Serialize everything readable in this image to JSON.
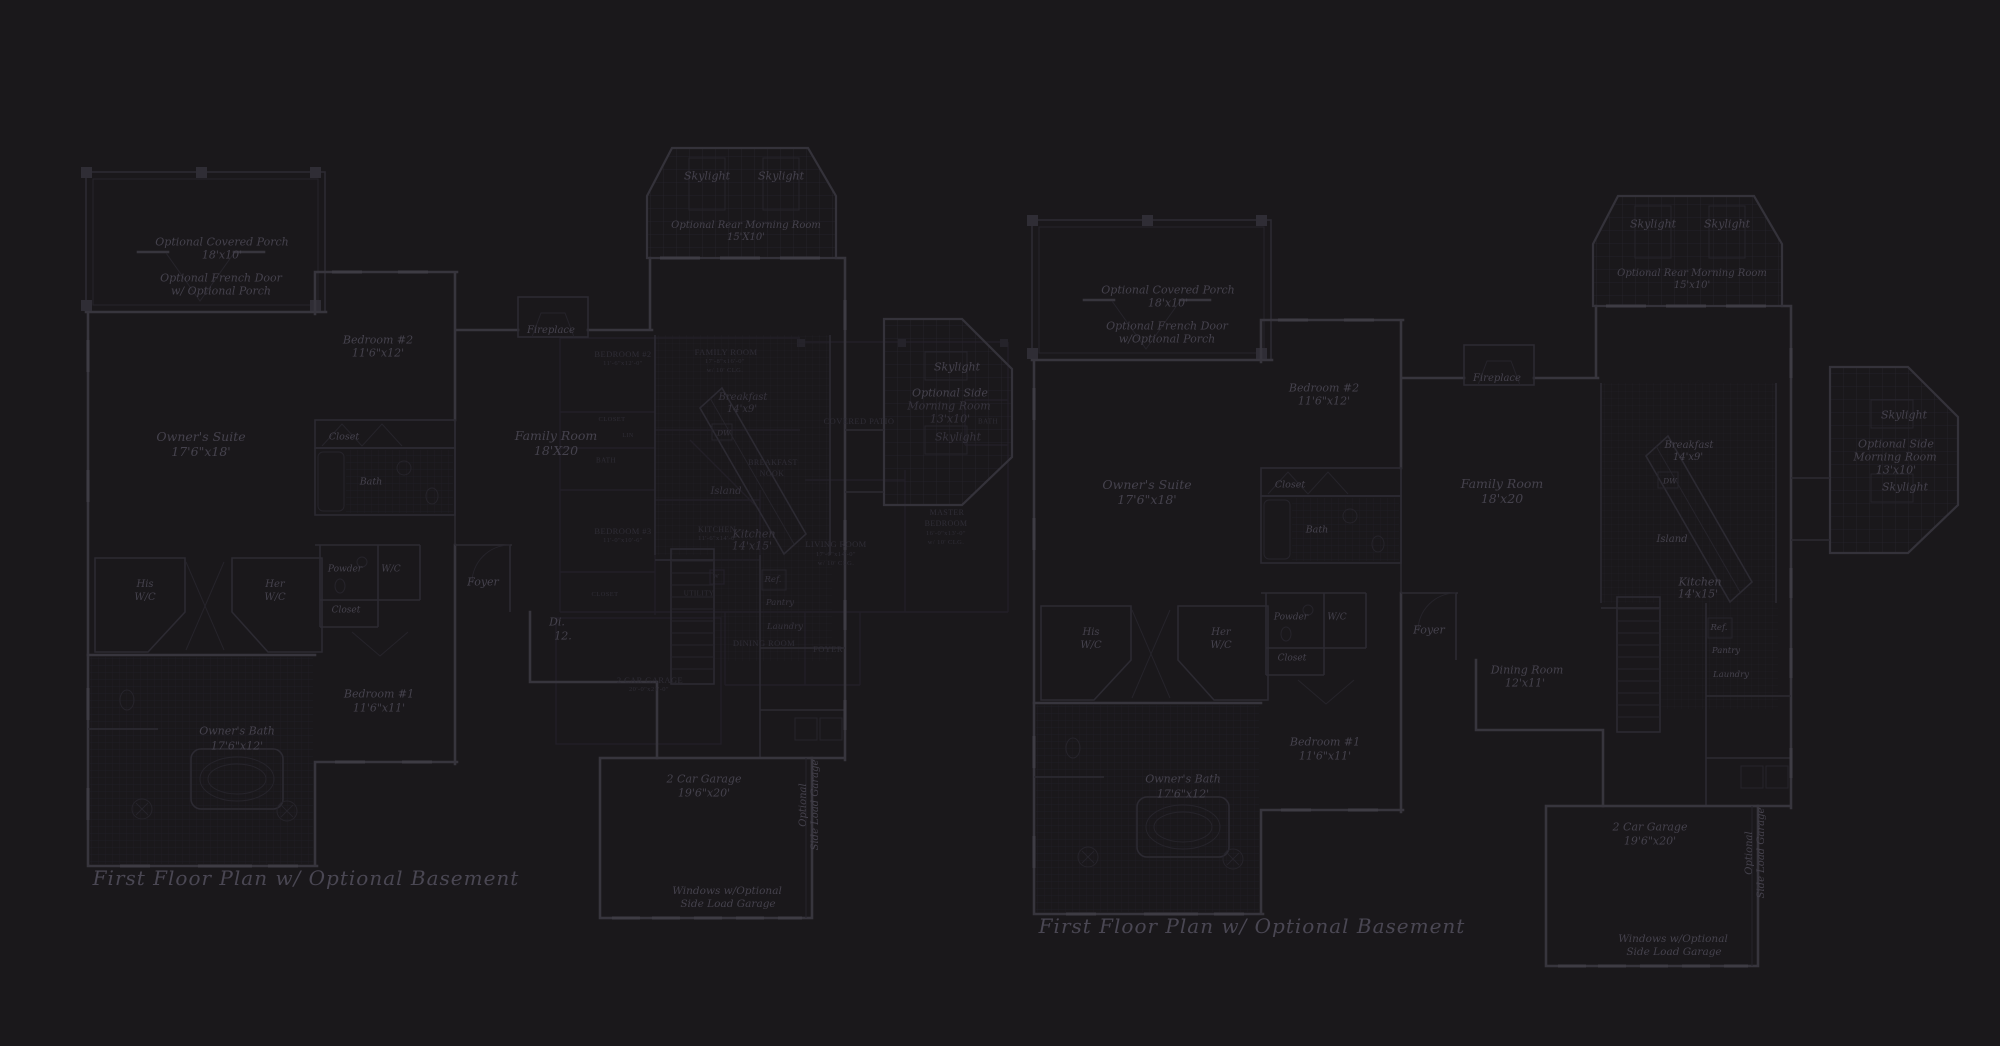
{
  "meta": {
    "figure_type": "architectural floor plan blueprint (dark background composite)",
    "colors": {
      "background": "#1a181b",
      "main_wall": "#37353d",
      "detail_line": "#2c2a32",
      "window_tick": "#3e3c44",
      "label_text": "#45424d",
      "faint_label_text": "#37343e",
      "overlay_text": "#2f2d36",
      "title_text": "#4a4753"
    }
  },
  "plans": {
    "left_plan": {
      "title": "First Floor Plan  w/ Optional Basement",
      "title_x": 306,
      "title_y": 878,
      "title_size": 20,
      "labels": [
        {
          "t": "Optional Covered Porch",
          "x": 222,
          "y": 242,
          "s": 11
        },
        {
          "t": "18'x10'",
          "x": 222,
          "y": 255,
          "s": 11
        },
        {
          "t": "Optional French Door",
          "x": 221,
          "y": 278,
          "s": 11
        },
        {
          "t": "w/ Optional Porch",
          "x": 221,
          "y": 291,
          "s": 11
        },
        {
          "t": "Skylight",
          "x": 707,
          "y": 176,
          "s": 11
        },
        {
          "t": "Skylight",
          "x": 781,
          "y": 176,
          "s": 11
        },
        {
          "t": "Optional Rear Morning Room",
          "x": 746,
          "y": 226,
          "s": 10
        },
        {
          "t": "15'X10'",
          "x": 746,
          "y": 238,
          "s": 10
        },
        {
          "t": "Bedroom #2",
          "x": 378,
          "y": 340,
          "s": 11
        },
        {
          "t": "11'6\"x12'",
          "x": 378,
          "y": 353,
          "s": 11
        },
        {
          "t": "Owner's Suite",
          "x": 201,
          "y": 437,
          "s": 12.5
        },
        {
          "t": "17'6\"x18'",
          "x": 201,
          "y": 452,
          "s": 12.5
        },
        {
          "t": "Closet",
          "x": 344,
          "y": 437,
          "s": 9.5
        },
        {
          "t": "Bath",
          "x": 371,
          "y": 482,
          "s": 9.5
        },
        {
          "t": "Fireplace",
          "x": 551,
          "y": 331,
          "s": 10
        },
        {
          "t": "Family Room",
          "x": 556,
          "y": 436,
          "s": 12.5
        },
        {
          "t": "18'X20",
          "x": 556,
          "y": 451,
          "s": 12.5
        },
        {
          "t": "Breakfast",
          "x": 743,
          "y": 398,
          "s": 10,
          "c": "af"
        },
        {
          "t": "14'x9'",
          "x": 742,
          "y": 410,
          "s": 10,
          "c": "af"
        },
        {
          "t": "DW",
          "x": 724,
          "y": 433,
          "s": 7.5,
          "c": "af"
        },
        {
          "t": "Island",
          "x": 726,
          "y": 492,
          "s": 10,
          "c": "af"
        },
        {
          "t": "Kitchen",
          "x": 754,
          "y": 534,
          "s": 11,
          "c": "af"
        },
        {
          "t": "14'x15'",
          "x": 752,
          "y": 546,
          "s": 11,
          "c": "af"
        },
        {
          "t": "Ref.",
          "x": 773,
          "y": 580,
          "s": 8.5,
          "c": "af"
        },
        {
          "t": "Pantry",
          "x": 780,
          "y": 603,
          "s": 8.5,
          "c": "af"
        },
        {
          "t": "Laundry",
          "x": 785,
          "y": 627,
          "s": 8.5,
          "c": "af"
        },
        {
          "t": "Skylight",
          "x": 957,
          "y": 367,
          "s": 11
        },
        {
          "t": "Optional Side",
          "x": 950,
          "y": 393,
          "s": 11
        },
        {
          "t": "Morning Room",
          "x": 949,
          "y": 406,
          "s": 11,
          "c": "af"
        },
        {
          "t": "13'x10'",
          "x": 950,
          "y": 419,
          "s": 11,
          "c": "af"
        },
        {
          "t": "Skylight",
          "x": 958,
          "y": 437,
          "s": 11,
          "c": "af"
        },
        {
          "t": "His",
          "x": 145,
          "y": 585,
          "s": 10
        },
        {
          "t": "W/C",
          "x": 145,
          "y": 598,
          "s": 10
        },
        {
          "t": "Her",
          "x": 275,
          "y": 585,
          "s": 10
        },
        {
          "t": "W/C",
          "x": 275,
          "y": 598,
          "s": 10
        },
        {
          "t": "Powder",
          "x": 345,
          "y": 570,
          "s": 9
        },
        {
          "t": "W/C",
          "x": 391,
          "y": 570,
          "s": 9
        },
        {
          "t": "Closet",
          "x": 346,
          "y": 611,
          "s": 9
        },
        {
          "t": "Foyer",
          "x": 483,
          "y": 582,
          "s": 11
        },
        {
          "t": "Di.",
          "x": 557,
          "y": 622,
          "s": 11
        },
        {
          "t": "12.",
          "x": 563,
          "y": 636,
          "s": 11
        },
        {
          "t": "Bedroom #1",
          "x": 379,
          "y": 694,
          "s": 11
        },
        {
          "t": "11'6\"x11'",
          "x": 379,
          "y": 708,
          "s": 11
        },
        {
          "t": "Owner's Bath",
          "x": 237,
          "y": 731,
          "s": 11
        },
        {
          "t": "17'6\"x12'",
          "x": 237,
          "y": 746,
          "s": 11
        },
        {
          "t": "2 Car Garage",
          "x": 704,
          "y": 779,
          "s": 11
        },
        {
          "t": "19'6\"x20'",
          "x": 704,
          "y": 793,
          "s": 11
        },
        {
          "t": "Optional",
          "x": 804,
          "y": 805,
          "s": 10,
          "r": -90
        },
        {
          "t": "Side Load Garage",
          "x": 816,
          "y": 805,
          "s": 10,
          "r": -90
        },
        {
          "t": "Windows w/Optional",
          "x": 727,
          "y": 891,
          "s": 10.5
        },
        {
          "t": "Side Load Garage",
          "x": 728,
          "y": 904,
          "s": 10.5
        }
      ]
    },
    "right_plan": {
      "title": "First Floor Plan  w/ Optional Basement",
      "title_x": 1252,
      "title_y": 926,
      "title_size": 20,
      "labels": [
        {
          "t": "Optional Covered Porch",
          "x": 1168,
          "y": 290,
          "s": 11
        },
        {
          "t": "18'x10'",
          "x": 1168,
          "y": 303,
          "s": 11
        },
        {
          "t": "Optional French Door",
          "x": 1167,
          "y": 326,
          "s": 11
        },
        {
          "t": "w/Optional Porch",
          "x": 1167,
          "y": 339,
          "s": 11
        },
        {
          "t": "Skylight",
          "x": 1653,
          "y": 224,
          "s": 11
        },
        {
          "t": "Skylight",
          "x": 1727,
          "y": 224,
          "s": 11
        },
        {
          "t": "Optional Rear Morning Room",
          "x": 1692,
          "y": 274,
          "s": 10
        },
        {
          "t": "15'x10'",
          "x": 1692,
          "y": 286,
          "s": 10
        },
        {
          "t": "Bedroom #2",
          "x": 1324,
          "y": 388,
          "s": 11
        },
        {
          "t": "11'6\"x12'",
          "x": 1324,
          "y": 401,
          "s": 11
        },
        {
          "t": "Owner's Suite",
          "x": 1147,
          "y": 485,
          "s": 12.5
        },
        {
          "t": "17'6\"x18'",
          "x": 1147,
          "y": 500,
          "s": 12.5
        },
        {
          "t": "Closet",
          "x": 1290,
          "y": 485,
          "s": 9.5
        },
        {
          "t": "Bath",
          "x": 1317,
          "y": 530,
          "s": 9.5
        },
        {
          "t": "Fireplace",
          "x": 1497,
          "y": 379,
          "s": 10
        },
        {
          "t": "Family Room",
          "x": 1502,
          "y": 484,
          "s": 12.5
        },
        {
          "t": "18'x20",
          "x": 1502,
          "y": 499,
          "s": 12.5
        },
        {
          "t": "Breakfast",
          "x": 1689,
          "y": 446,
          "s": 10
        },
        {
          "t": "14'x9'",
          "x": 1688,
          "y": 458,
          "s": 10
        },
        {
          "t": "DW",
          "x": 1670,
          "y": 481,
          "s": 7.5
        },
        {
          "t": "Island",
          "x": 1672,
          "y": 540,
          "s": 10
        },
        {
          "t": "Kitchen",
          "x": 1700,
          "y": 582,
          "s": 11
        },
        {
          "t": "14'x15'",
          "x": 1698,
          "y": 594,
          "s": 11
        },
        {
          "t": "Ref.",
          "x": 1719,
          "y": 628,
          "s": 8.5
        },
        {
          "t": "Pantry",
          "x": 1726,
          "y": 651,
          "s": 8.5
        },
        {
          "t": "Laundry",
          "x": 1731,
          "y": 675,
          "s": 8.5
        },
        {
          "t": "Skylight",
          "x": 1904,
          "y": 415,
          "s": 11
        },
        {
          "t": "Optional Side",
          "x": 1896,
          "y": 444,
          "s": 11
        },
        {
          "t": "Morning Room",
          "x": 1895,
          "y": 457,
          "s": 11
        },
        {
          "t": "13'x10'",
          "x": 1896,
          "y": 470,
          "s": 11
        },
        {
          "t": "Skylight",
          "x": 1905,
          "y": 487,
          "s": 11
        },
        {
          "t": "His",
          "x": 1091,
          "y": 633,
          "s": 10
        },
        {
          "t": "W/C",
          "x": 1091,
          "y": 646,
          "s": 10
        },
        {
          "t": "Her",
          "x": 1221,
          "y": 633,
          "s": 10
        },
        {
          "t": "W/C",
          "x": 1221,
          "y": 646,
          "s": 10
        },
        {
          "t": "Powder",
          "x": 1291,
          "y": 618,
          "s": 9
        },
        {
          "t": "W/C",
          "x": 1337,
          "y": 618,
          "s": 9
        },
        {
          "t": "Closet",
          "x": 1292,
          "y": 659,
          "s": 9
        },
        {
          "t": "Foyer",
          "x": 1429,
          "y": 630,
          "s": 11
        },
        {
          "t": "Dining Room",
          "x": 1527,
          "y": 670,
          "s": 11
        },
        {
          "t": "12'x11'",
          "x": 1525,
          "y": 683,
          "s": 11
        },
        {
          "t": "Bedroom #1",
          "x": 1325,
          "y": 742,
          "s": 11
        },
        {
          "t": "11'6\"x11'",
          "x": 1325,
          "y": 756,
          "s": 11
        },
        {
          "t": "Owner's Bath",
          "x": 1183,
          "y": 779,
          "s": 11
        },
        {
          "t": "17'6\"x12'",
          "x": 1183,
          "y": 794,
          "s": 11
        },
        {
          "t": "2 Car Garage",
          "x": 1650,
          "y": 827,
          "s": 11
        },
        {
          "t": "19'6\"x20'",
          "x": 1650,
          "y": 841,
          "s": 11
        },
        {
          "t": "Optional",
          "x": 1750,
          "y": 853,
          "s": 10,
          "r": -90
        },
        {
          "t": "Side Load Garage",
          "x": 1762,
          "y": 853,
          "s": 10,
          "r": -90
        },
        {
          "t": "Windows w/Optional",
          "x": 1673,
          "y": 939,
          "s": 10.5
        },
        {
          "t": "Side Load Garage",
          "x": 1674,
          "y": 952,
          "s": 10.5
        }
      ]
    },
    "background_plan": {
      "labels": [
        {
          "t": "BEDROOM #2",
          "x": 623,
          "y": 354,
          "s": 8.5
        },
        {
          "t": "11'-6\"x12'-0\"",
          "x": 623,
          "y": 364,
          "s": 6.5
        },
        {
          "t": "FAMILY ROOM",
          "x": 726,
          "y": 352,
          "s": 8.5
        },
        {
          "t": "17'-8\"x16'-0\"",
          "x": 725,
          "y": 362,
          "s": 6.5
        },
        {
          "t": "w/ 10' CLG.",
          "x": 725,
          "y": 371,
          "s": 6.5
        },
        {
          "t": "CLOSET",
          "x": 612,
          "y": 420,
          "s": 6.5
        },
        {
          "t": "LIN",
          "x": 628,
          "y": 436,
          "s": 6
        },
        {
          "t": "BATH",
          "x": 606,
          "y": 461,
          "s": 7
        },
        {
          "t": "BEDROOM #3",
          "x": 623,
          "y": 531,
          "s": 8.5
        },
        {
          "t": "11'-0\"x10'-6\"",
          "x": 623,
          "y": 541,
          "s": 6.5
        },
        {
          "t": "CLOSET",
          "x": 605,
          "y": 595,
          "s": 6.5
        },
        {
          "t": "W",
          "x": 716,
          "y": 577,
          "s": 6.5
        },
        {
          "t": "UTILITY",
          "x": 699,
          "y": 594,
          "s": 7
        },
        {
          "t": "2 CAR GARAGE",
          "x": 650,
          "y": 680,
          "s": 8.5
        },
        {
          "t": "20'-0\"x21'-0\"",
          "x": 649,
          "y": 690,
          "s": 6.5
        },
        {
          "t": "BREAKFAST",
          "x": 773,
          "y": 463,
          "s": 8
        },
        {
          "t": "NOOK",
          "x": 772,
          "y": 474,
          "s": 8
        },
        {
          "t": "KITCHEN",
          "x": 717,
          "y": 530,
          "s": 8
        },
        {
          "t": "11'-6\"x14'-0\"",
          "x": 718,
          "y": 539,
          "s": 6.5
        },
        {
          "t": "COVERED PATIO",
          "x": 859,
          "y": 421,
          "s": 8.5
        },
        {
          "t": "LIVING ROOM",
          "x": 836,
          "y": 544,
          "s": 8.5
        },
        {
          "t": "17'-0\"x14'-0\"",
          "x": 836,
          "y": 555,
          "s": 6.5
        },
        {
          "t": "w/ 10' CLG.",
          "x": 836,
          "y": 564,
          "s": 6.5
        },
        {
          "t": "MASTER",
          "x": 947,
          "y": 513,
          "s": 8
        },
        {
          "t": "BEDROOM",
          "x": 946,
          "y": 524,
          "s": 8
        },
        {
          "t": "16'-0\"x13'-0\"",
          "x": 946,
          "y": 534,
          "s": 6.5
        },
        {
          "t": "w/ 10' CLG.",
          "x": 946,
          "y": 543,
          "s": 6.5
        },
        {
          "t": "DINING ROOM",
          "x": 764,
          "y": 643,
          "s": 8.5
        },
        {
          "t": "FOYER",
          "x": 828,
          "y": 649,
          "s": 8.5
        },
        {
          "t": "BATH",
          "x": 988,
          "y": 422,
          "s": 7
        }
      ]
    }
  }
}
